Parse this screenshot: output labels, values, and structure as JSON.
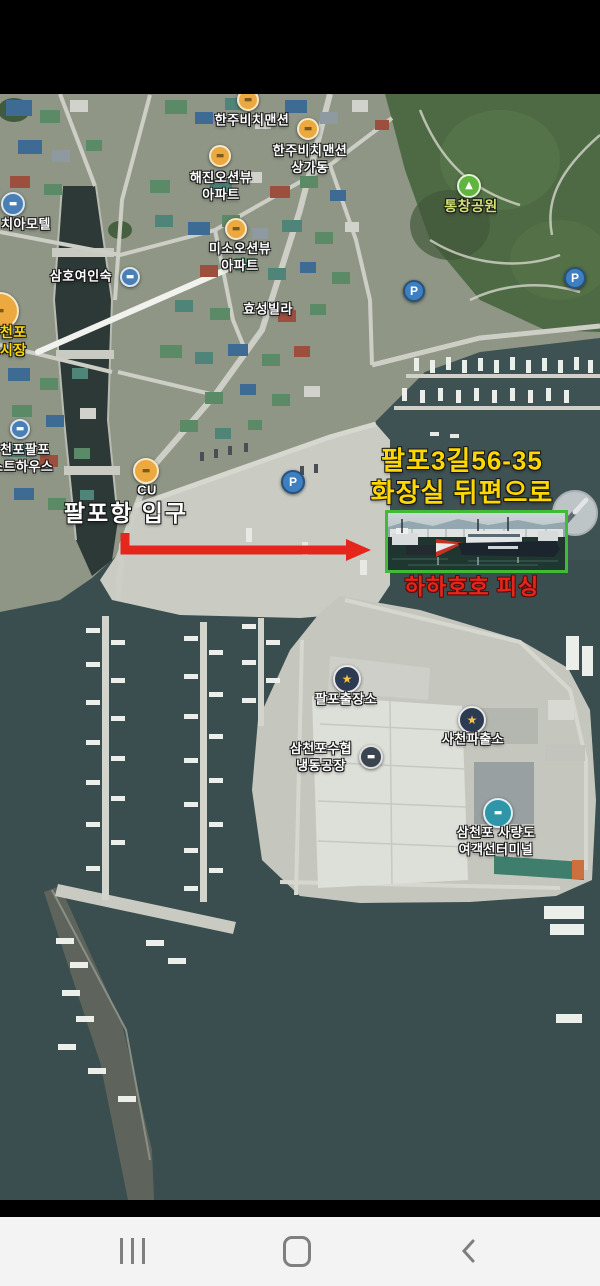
{
  "colors": {
    "accent_red": "#e5261d",
    "accent_yellow": "#ffd800",
    "label_green": "#d3e273",
    "box_green": "#3fbb35",
    "water": "#3e5153"
  },
  "icons": {
    "parking": "P",
    "police_star": "★",
    "park_tree": "▲",
    "building": "▬"
  },
  "labels": {
    "hanju_mansion": {
      "text": "한주비치맨션"
    },
    "hanju_annex": {
      "line1": "한주비치맨션",
      "line2": "상가동"
    },
    "haejin": {
      "line1": "해진오션뷰",
      "line2": "아파트"
    },
    "park": {
      "text": "통창공원"
    },
    "chia_motel": {
      "text": "치아모텔"
    },
    "samho_inn": {
      "text": "삼호여인숙"
    },
    "miso": {
      "line1": "미소오션뷰",
      "line2": "아파트"
    },
    "hyoseong": {
      "text": "효성빌라"
    },
    "market": {
      "line1": "천포",
      "line2": "시장"
    },
    "guesthouse": {
      "line1": "천포팔포",
      "line2": "스트하우스"
    },
    "cu": {
      "text": "CU"
    },
    "port_entrance": {
      "text": "팔포항 입구"
    },
    "address": {
      "line1": "팔포3길56-35",
      "line2": "화장실 뒤편으로"
    },
    "fishing": {
      "text": "하하호호 피싱"
    },
    "palpo_branch": {
      "text": "팔포출장소"
    },
    "suhyup": {
      "line1": "삼천포수협",
      "line2": "냉동공장"
    },
    "police": {
      "text": "사천파출소"
    },
    "terminal": {
      "line1": "삼천포 사량도",
      "line2": "여객선터미널"
    }
  }
}
